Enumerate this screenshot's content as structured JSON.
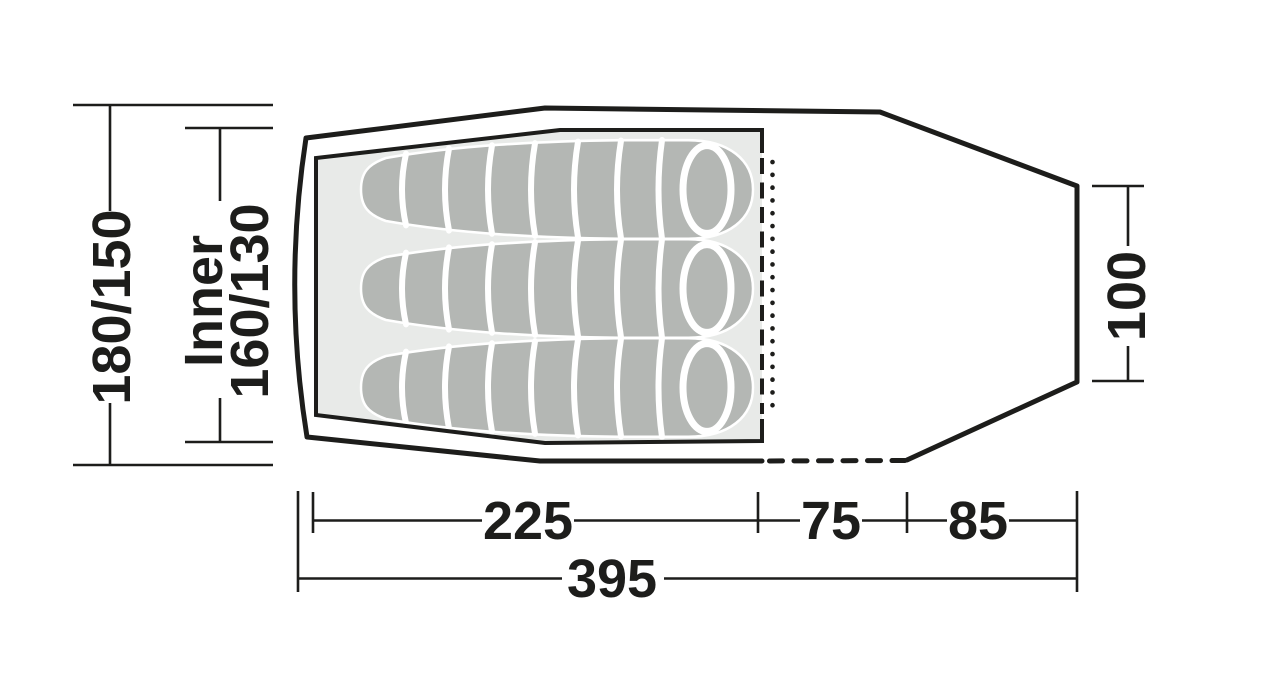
{
  "diagram": {
    "type": "tent-floor-plan",
    "sleeping_bag_count": 3,
    "colors": {
      "line": "#1d1d1b",
      "floor": "#e8eae8",
      "sleeping_bag": "#b4b7b4",
      "background": "#ffffff"
    },
    "dimensions": {
      "outer_width": {
        "label": "180/150"
      },
      "inner_width": {
        "prefix": "Inner",
        "label": "160/130"
      },
      "rear_width": {
        "label": "100"
      },
      "inner_length": {
        "label": "225"
      },
      "front_depth": {
        "label": "75"
      },
      "porch_depth": {
        "label": "85"
      },
      "total_length": {
        "label": "395"
      }
    }
  }
}
